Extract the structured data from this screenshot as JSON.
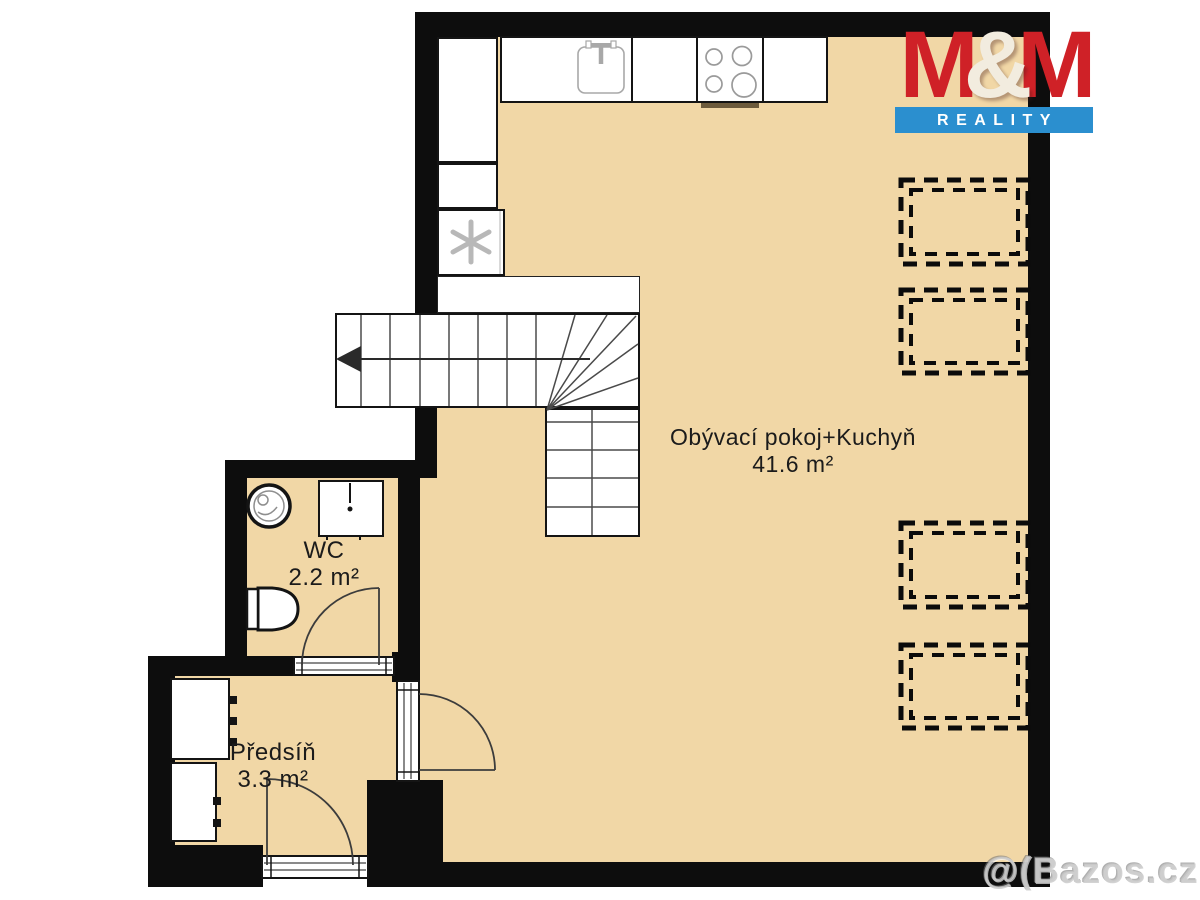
{
  "page": {
    "background": "#ffffff"
  },
  "plan": {
    "rooms": [
      {
        "name": "Obývací pokoj+Kuchyň",
        "area": "41.6 m²"
      },
      {
        "name": "WC",
        "area": "2.2 m²"
      },
      {
        "name": "Předsíň",
        "area": "3.3 m²"
      }
    ],
    "colors": {
      "floor": "#f1d7a6",
      "wall": "#0d0d0d"
    },
    "fixtures": [
      "sink-icon",
      "stove-icon",
      "snowflake-icon",
      "washing-machine-icon",
      "water-heater-icon",
      "toilet-icon",
      "stairs-icon",
      "arrow-left-icon",
      "door-arc-icon",
      "dashed-furniture"
    ]
  },
  "branding": {
    "logo": {
      "m_left": "M",
      "ampersand": "&",
      "m_right": "M",
      "subtitle": "REALITY",
      "red": "#cf2127",
      "blue": "#2b8fcf",
      "cream": "#f2ecdf"
    },
    "watermark": "@(Bazos.cz"
  }
}
